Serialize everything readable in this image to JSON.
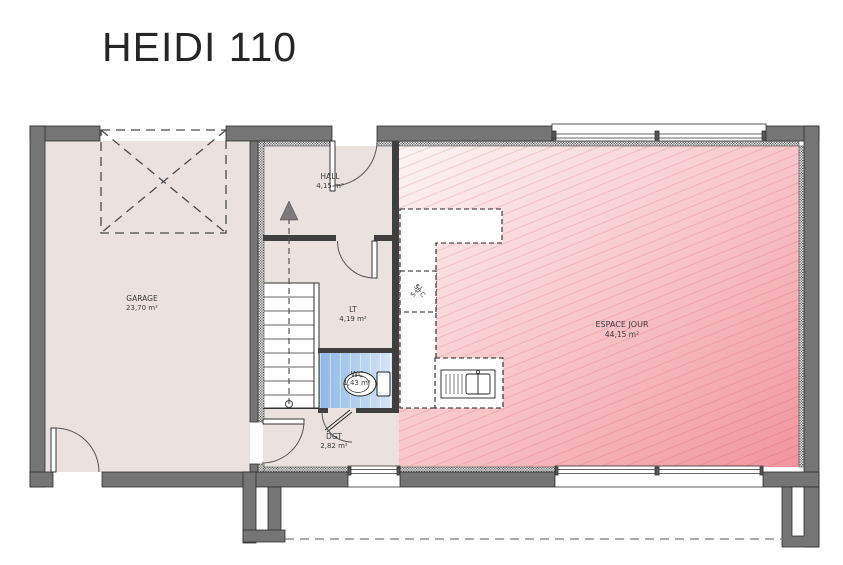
{
  "title": "HEIDI 110",
  "plan": {
    "rooms": [
      {
        "name": "GARAGE",
        "area": "23,70 m²"
      },
      {
        "name": "HALL",
        "area": "4,15 m²"
      },
      {
        "name": "LT",
        "area": "4,19 m²"
      },
      {
        "name": "WC",
        "area": "1,43 m²"
      },
      {
        "name": "DGT",
        "area": "2,82 m²"
      },
      {
        "name": "ESPACE JOUR",
        "area": "44,15 m²"
      }
    ],
    "duct_label": "S+C",
    "colors": {
      "wall": "#757575",
      "floor": "#ebe2e0",
      "living_gradient_start": "#fdf5f4",
      "living_gradient_end": "#f1949d",
      "wc_gradient_start": "#8db6e4",
      "wc_gradient_end": "#d6e6f7"
    }
  }
}
